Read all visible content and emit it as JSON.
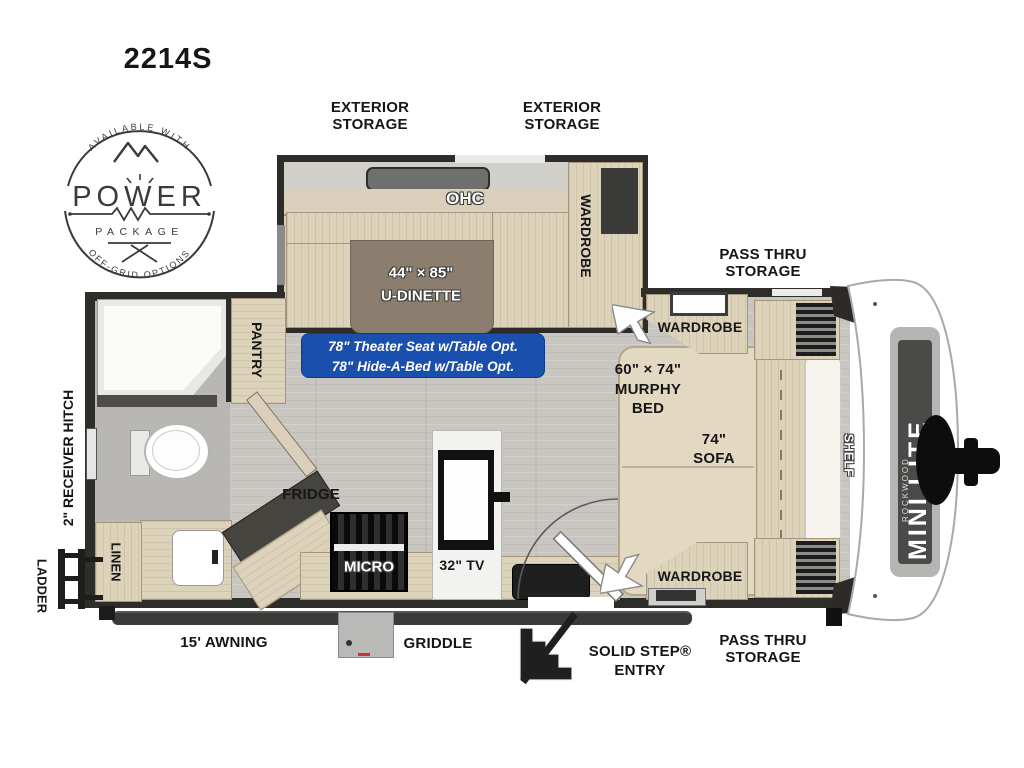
{
  "model": "2214S",
  "badge": {
    "top": "AVAILABLE WITH",
    "name": "POWER",
    "sub": "PACKAGE",
    "bottom": "OFF-GRID OPTIONS"
  },
  "labels": {
    "exterior_storage": [
      "EXTERIOR",
      "STORAGE"
    ],
    "pass_thru": [
      "PASS THRU",
      "STORAGE"
    ],
    "receiver_hitch": "2\" RECEIVER HITCH",
    "ladder": "LADDER",
    "linen": "LINEN",
    "pantry": "PANTRY",
    "fridge": "FRIDGE",
    "micro": "MICRO",
    "tv": "32\" TV",
    "ohc": "OHC",
    "wardrobe": "WARDROBE",
    "shelf": "SHELF",
    "awning": "15' AWNING",
    "griddle": "GRIDDLE",
    "entry": [
      "SOLID STEP®",
      "ENTRY"
    ],
    "dinette": [
      "44\" × 85\"",
      "U-DINETTE"
    ],
    "murphy": [
      "60\" × 74\"",
      "MURPHY",
      "BED"
    ],
    "sofa": [
      "74\"",
      "SOFA"
    ],
    "options": [
      "78\" Theater Seat w/Table Opt.",
      "78\" Hide-A-Bed w/Table Opt."
    ],
    "brand": "MINI LITE",
    "brand_maker": "ROCKWOOD"
  },
  "colors": {
    "wall": "#2e2d2a",
    "floor": "#c9c6c1",
    "furniture": "#ddd3bb",
    "table": "#8c7e6e",
    "option_box": "#1b4fae",
    "label": "#161616"
  }
}
